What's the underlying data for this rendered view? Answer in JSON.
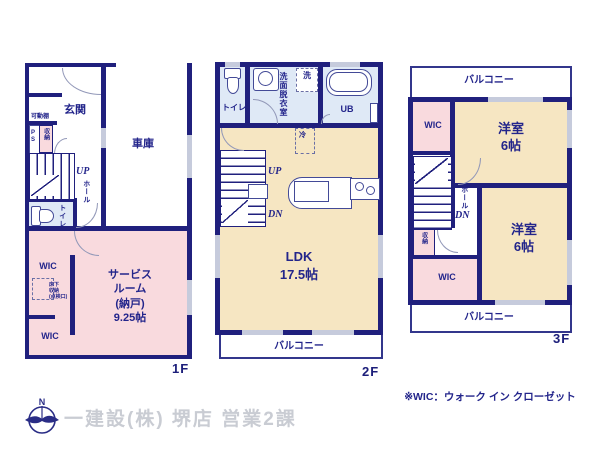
{
  "note": "※WIC：ウォーク イン クローゼット",
  "company": "一建設(株) 堺店 営業2課",
  "compass": {
    "north": "N"
  },
  "floor1": {
    "label": "1F",
    "entrance": "玄関",
    "shelf": "可動棚",
    "pipe_space": "PS",
    "storage": "収納",
    "up": "UP",
    "hall": "ホール",
    "toilet": "トイレ",
    "garage": "車庫",
    "wic_upper": "WIC",
    "underfloor_storage": "床下\n収納\n(点検口)",
    "service_room": "サービス\nルーム\n(納戸)\n9.25帖",
    "wic_lower": "WIC"
  },
  "floor2": {
    "label": "2F",
    "toilet": "トイレ",
    "washroom": "洗面脱衣室",
    "washer": "洗",
    "bath": "UB",
    "fridge": "冷",
    "up": "UP",
    "down": "DN",
    "ldk": "LDK\n17.5帖",
    "balcony": "バルコニー"
  },
  "floor3": {
    "label": "3F",
    "balcony_top": "バルコニー",
    "wic_upper": "WIC",
    "room_upper": "洋室\n6帖",
    "hall": "ホール",
    "down": "DN",
    "closet": "収納",
    "wic_lower": "WIC",
    "room_lower": "洋室\n6帖",
    "balcony_bottom": "バルコニー"
  }
}
